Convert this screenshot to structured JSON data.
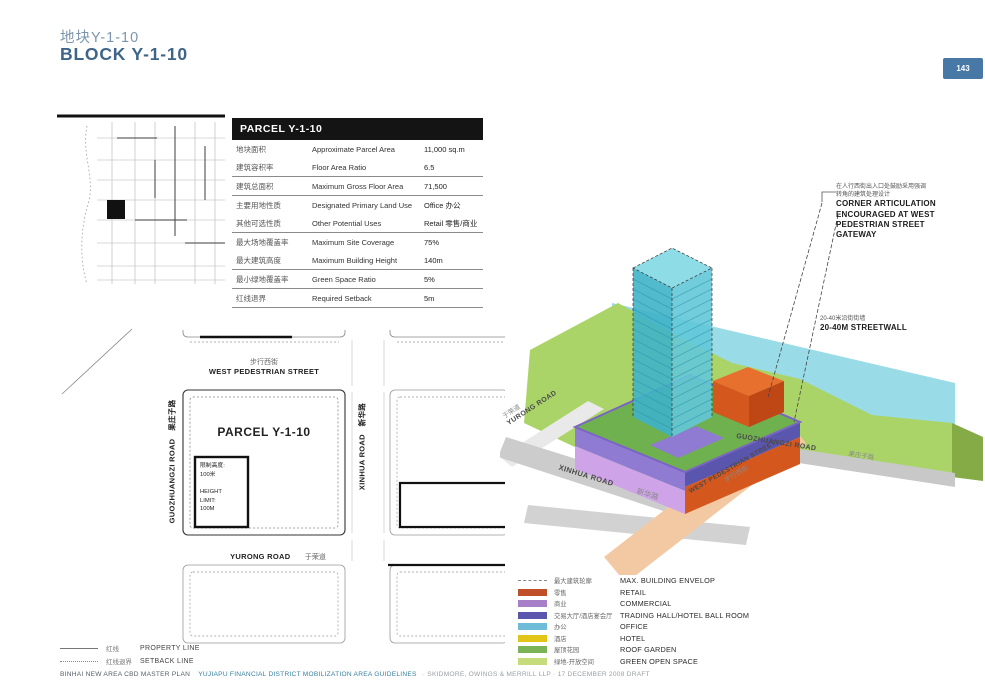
{
  "page": {
    "title_zh": "地块Y-1-10",
    "title_en": "BLOCK Y-1-10",
    "page_number": "143"
  },
  "parcel_table": {
    "header": "PARCEL Y-1-10",
    "rows": [
      {
        "zh": "地块面积",
        "en": "Approximate Parcel Area",
        "value": "11,000 sq.m"
      },
      {
        "zh": "建筑容积率",
        "en": "Floor Area Ratio",
        "value": "6.5"
      },
      {
        "zh": "建筑总面积",
        "en": "Maximum Gross Floor Area",
        "value": "71,500"
      },
      {
        "zh": "主要用地性质",
        "en": "Designated Primary Land Use",
        "value": "Office 办公"
      },
      {
        "zh": "其他可选性质",
        "en": "Other Potential Uses",
        "value": "Retail 零售/商业"
      },
      {
        "zh": "最大场地覆盖率",
        "en": "Maximum Site Coverage",
        "value": "75%"
      },
      {
        "zh": "最大建筑高度",
        "en": "Maximum Building Height",
        "value": "140m"
      },
      {
        "zh": "最小绿地覆盖率",
        "en": "Green Space Ratio",
        "value": "5%"
      },
      {
        "zh": "红线退界",
        "en": "Required Setback",
        "value": "5m"
      }
    ]
  },
  "site_plan": {
    "west_ped_zh": "步行西街",
    "west_ped_en": "WEST PEDESTRIAN STREET",
    "parcel_label": "PARCEL Y-1-10",
    "guozhuangzi_label": "GUOZHUANGZI ROAD　果庄子路",
    "xinhua_label": "XINHUA ROAD　新华路",
    "yurong_en": "YURONG ROAD",
    "yurong_zh": "于荣道",
    "height_limit": "限制高度:\n100米\n\nHEIGHT\nLIMIT:\n100M",
    "legend": [
      {
        "zh": "红线",
        "en": "PROPERTY LINE"
      },
      {
        "zh": "红线退界",
        "en": "SETBACK LINE"
      }
    ]
  },
  "axon": {
    "yurong_zh": "于荣道",
    "yurong_en": "YURONG ROAD",
    "xinhua_en": "XINHUA ROAD",
    "xinhua_zh": "新华路",
    "guozhuangzi_en": "GUOZHUANGZI ROAD",
    "guozhuangzi_zh": "果庄子路",
    "west_ped_en": "WEST PEDESTRIAN STREET",
    "west_ped_zh": "步行西街",
    "corner_note_zh": "在人行西街出入口处鼓励采用强调\n转角的建筑处理设计",
    "corner_note_en": "CORNER ARTICULATION\nENCOURAGED AT WEST\nPEDESTRIAN STREET\nGATEWAY",
    "streetwall_zh": "20-40米沿街街墙",
    "streetwall_en": "20-40M STREETWALL"
  },
  "legend": {
    "items": [
      {
        "zh": "最大建筑轮廓",
        "en": "MAX. BUILDING ENVELOP",
        "color": ""
      },
      {
        "zh": "零售",
        "en": "RETAIL",
        "color": "#bf4f28"
      },
      {
        "zh": "商业",
        "en": "COMMERCIAL",
        "color": "#a77fc9"
      },
      {
        "zh": "交易大厅/酒店宴会厅",
        "en": "TRADING HALL/HOTEL BALL ROOM",
        "color": "#5a55ad"
      },
      {
        "zh": "办公",
        "en": "OFFICE",
        "color": "#6fbcd9"
      },
      {
        "zh": "酒店",
        "en": "HOTEL",
        "color": "#e3c419"
      },
      {
        "zh": "屋顶花园",
        "en": "ROOF GARDEN",
        "color": "#7cb356"
      },
      {
        "zh": "绿地-开放空间",
        "en": "GREEN OPEN SPACE",
        "color": "#c6dc7a"
      }
    ]
  },
  "footer": {
    "seg1": "BINHAI NEW AREA CBD MASTER PLAN",
    "seg2": "YUJIAPU FINANCIAL DISTRICT MOBILIZATION AREA GUIDELINES",
    "seg3": "· SKIDMORE, OWINGS & MERRILL LLP · 17 DECEMBER 2008 DRAFT"
  },
  "colors": {
    "title_blue": "#3e6588",
    "title_blue_light": "#7b96ac",
    "badge_blue": "#4878a6",
    "footer_teal": "#38819f",
    "tower_office": "#45b6c9",
    "podium_trading_hall": "#5a55ad",
    "podium_commercial": "#cfa3e8",
    "retail_orange": "#d4571e",
    "roof_garden_green": "#6fb04f",
    "open_space_green": "#aad468",
    "water_cyan": "#9adbe8",
    "road_gray": "#c9c9c9",
    "pedestrian_street_peach": "#f2c9a2"
  }
}
